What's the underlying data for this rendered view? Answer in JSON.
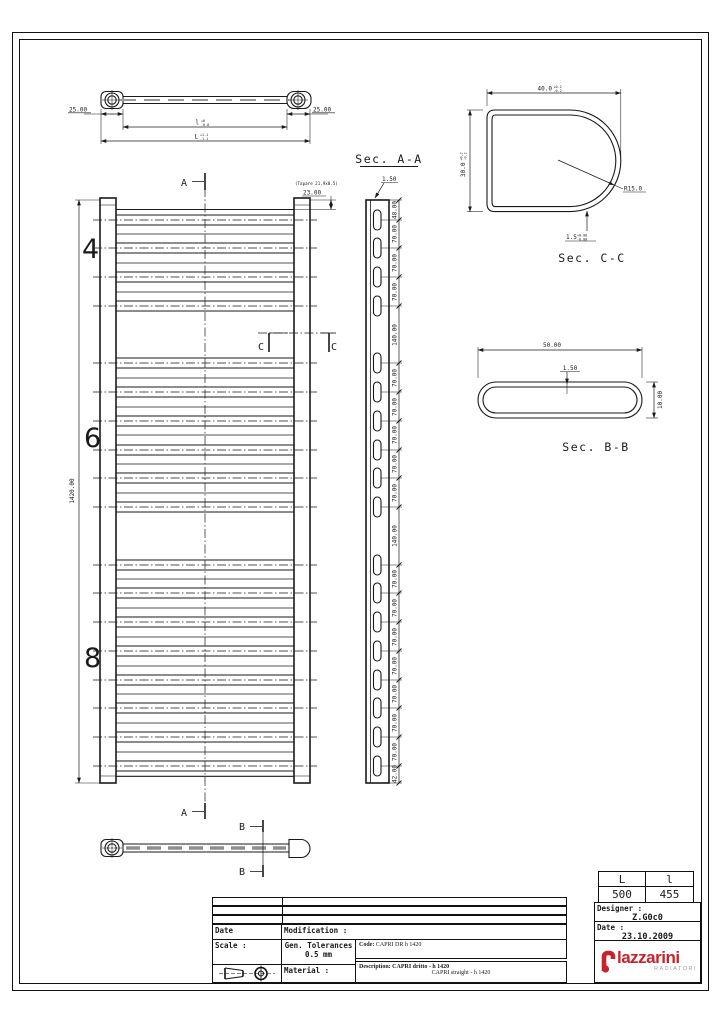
{
  "markers": {
    "a": "A",
    "b": "B",
    "c": "C"
  },
  "top_view": {
    "dim_left": "25.00",
    "dim_right": "25.00",
    "dim_inner_main": "l",
    "dim_inner_tol_top": "+0",
    "dim_inner_tol_bot": "-0.8",
    "dim_outer_main": "L",
    "dim_outer_tol_top": "+1.1",
    "dim_outer_tol_bot": "-1.1"
  },
  "front_view": {
    "height_dim": "1420.00",
    "group_labels": [
      "4",
      "6",
      "8"
    ],
    "cap_note": "(Tapare 21.9x0.5)",
    "top_dim": "23.00"
  },
  "sec_aa": {
    "title": "Sec. A-A",
    "wall_dim": "1.50",
    "dims": [
      "48.00",
      "70.00",
      "70.00",
      "70.00",
      "140.00",
      "70.00",
      "70.00",
      "70.00",
      "70.00",
      "70.00",
      "140.00",
      "70.00",
      "70.00",
      "70.00",
      "70.00",
      "70.00",
      "70.00",
      "70.00",
      "42.00"
    ]
  },
  "sec_cc": {
    "title": "Sec. C-C",
    "width": "40.0",
    "width_tol_top": "+0.2",
    "width_tol_bot": "-0.2",
    "height": "30.0",
    "height_tol_top": "+0.2",
    "height_tol_bot": "-0.2",
    "radius": "R15.0",
    "wall": "1.5",
    "wall_tol_top": "+0.08",
    "wall_tol_bot": "-0.08"
  },
  "sec_bb": {
    "title": "Sec. B-B",
    "width": "50.00",
    "wall": "1.50",
    "height": "10.00"
  },
  "title_block": {
    "size_table": {
      "col1": "L",
      "col2": "l",
      "val1": "500",
      "val2": "455"
    },
    "designer_label": "Designer :",
    "designer_value": "Z.G0c0",
    "date_label": "Date :",
    "date_value": "23.10.2009",
    "rows": {
      "date": "Date",
      "modification": "Modification :",
      "scale": "Scale :",
      "gen_tol_line1": "Gen. Tolerances",
      "gen_tol_line2": "0.5 mm",
      "material": "Material :"
    },
    "code_label": "Code:",
    "code_value": "CAPRI DR h 1420",
    "desc_label": "Description:",
    "desc_value1": "CAPRI dritto - h 1420",
    "desc_value2": "CAPRI straight - h 1420",
    "logo": {
      "name": "lazzarini",
      "sub": "RADIATORI"
    }
  }
}
